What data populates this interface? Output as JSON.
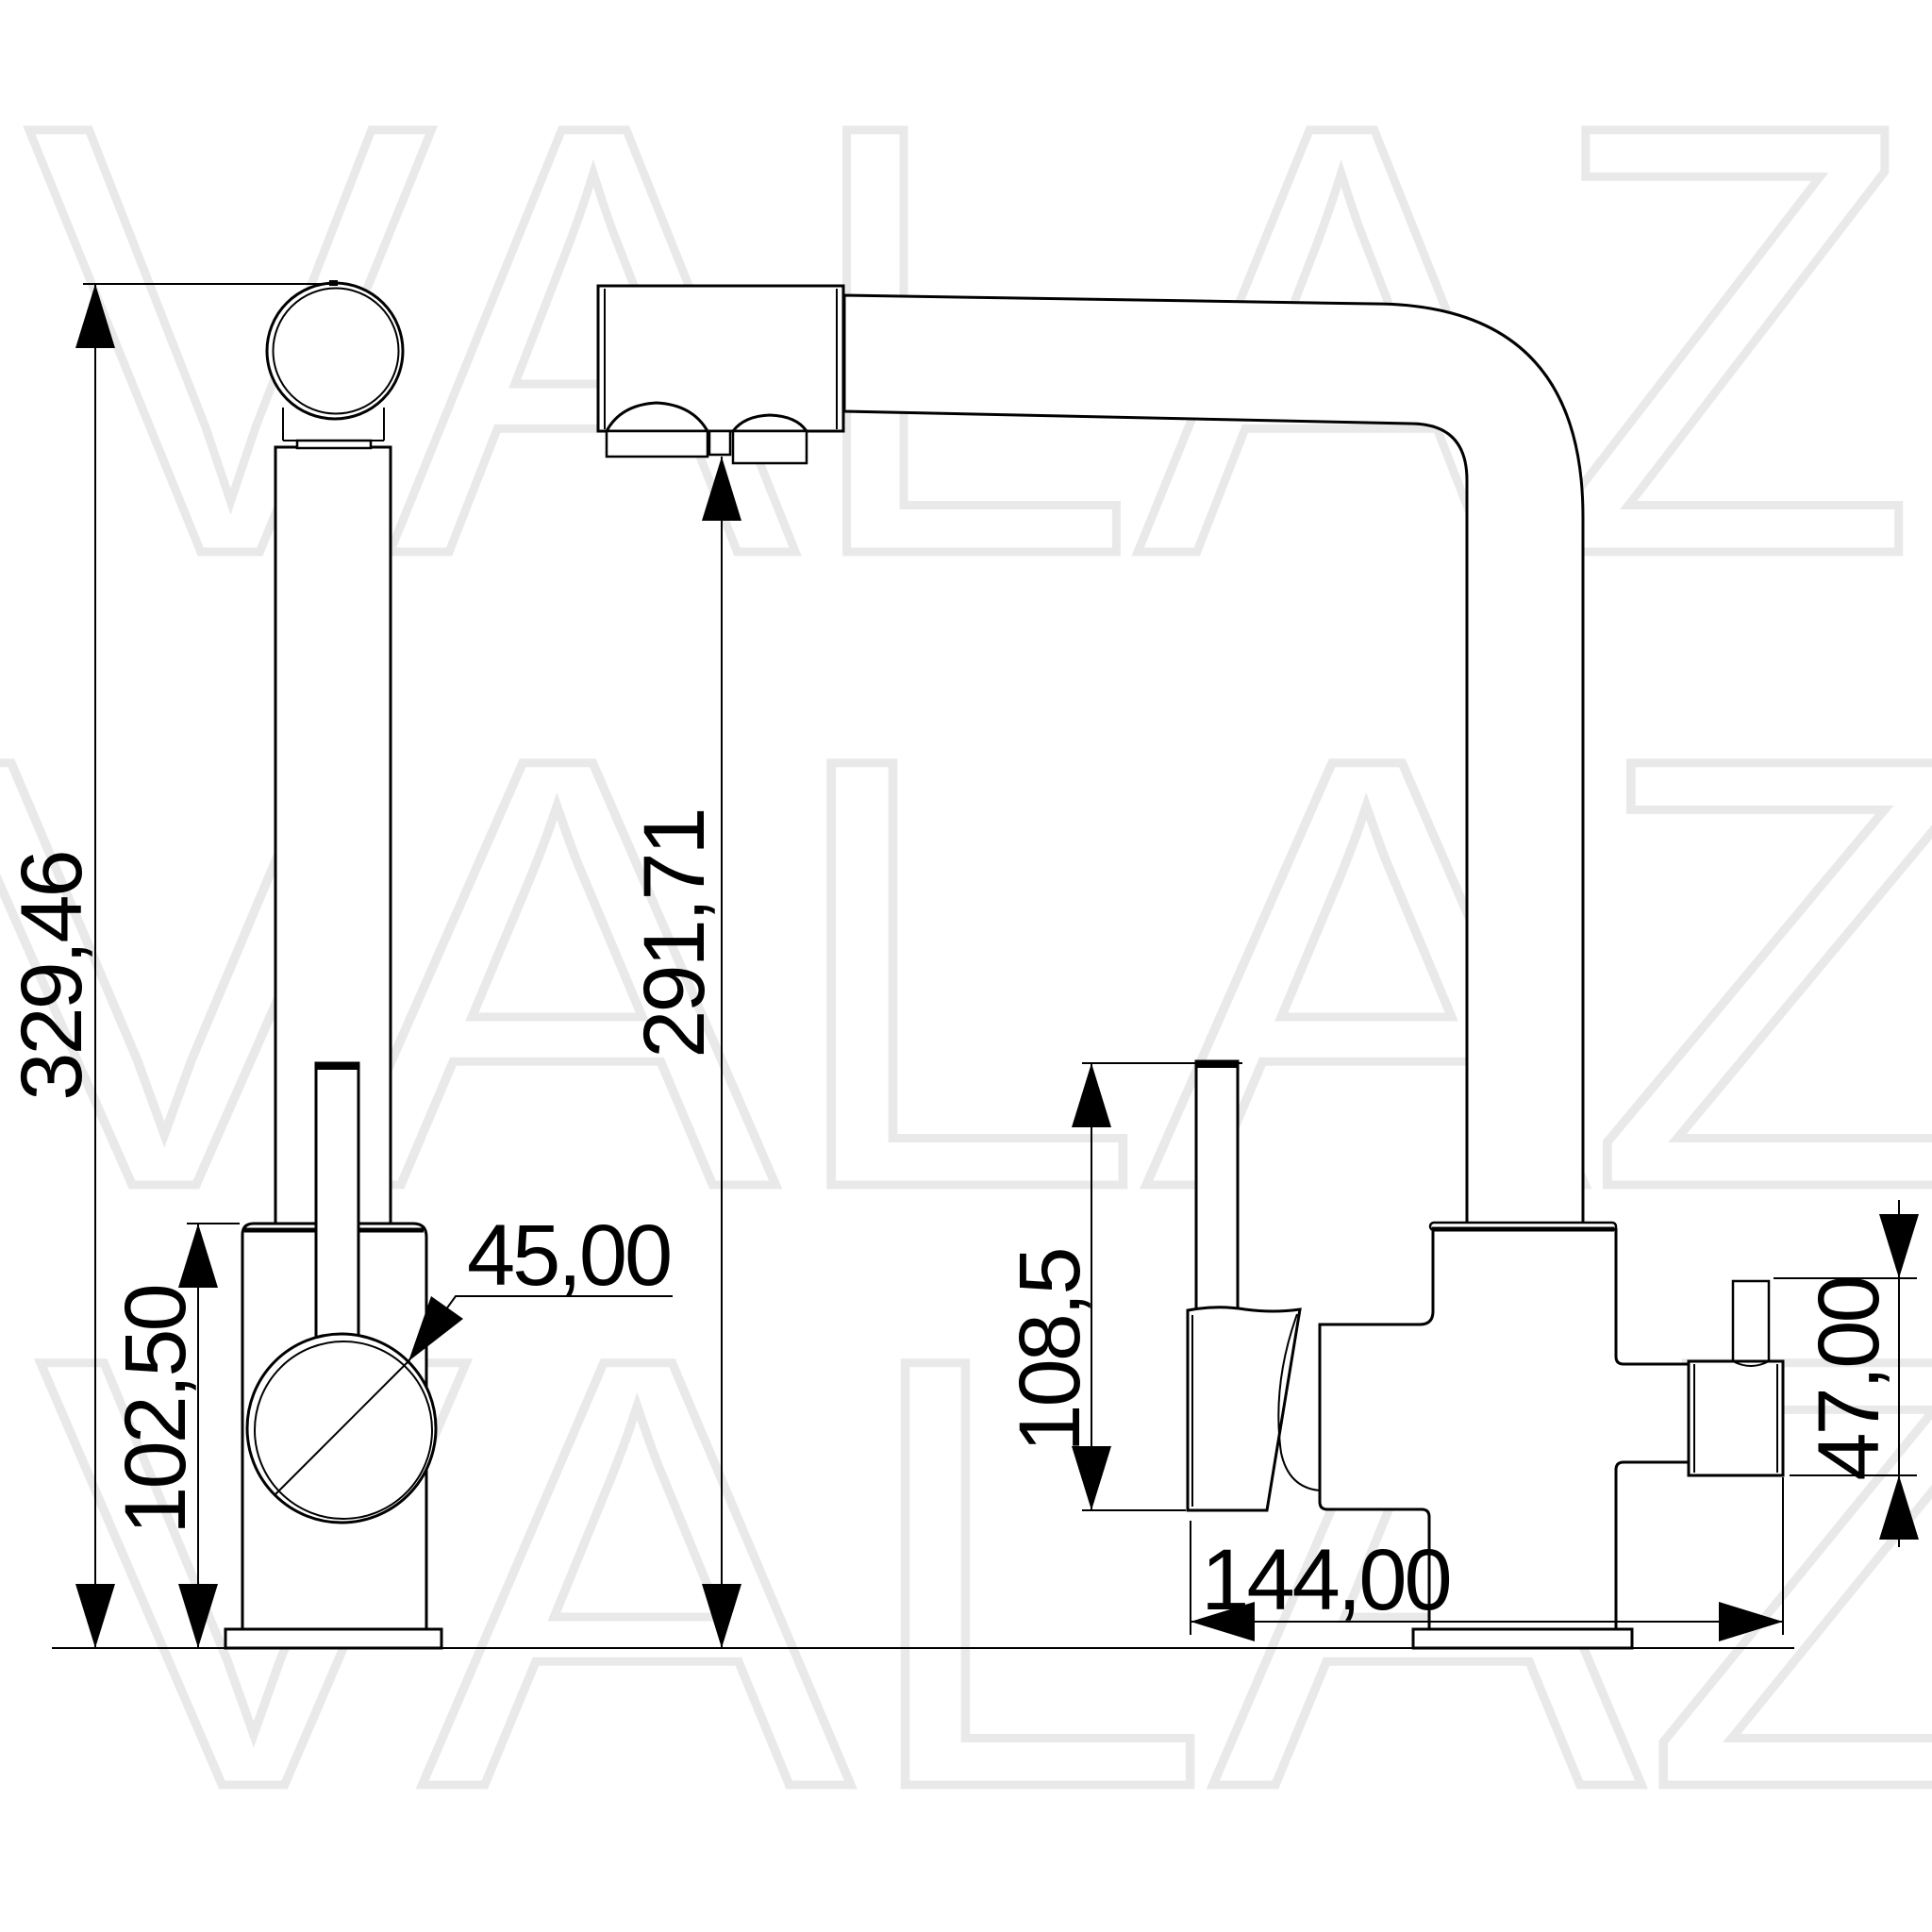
{
  "drawing": {
    "background": "#ffffff",
    "line_color": "#000000"
  },
  "watermark": {
    "text": "VALAZ",
    "color": "#e9e9e9"
  },
  "dimensions": {
    "total_height": "329,46",
    "body_height": "102,50",
    "handle_diameter": "45,00",
    "outlet_height": "291,71",
    "lever_height": "108,5",
    "side_outlet_height": "47,00",
    "depth": "144,00"
  }
}
